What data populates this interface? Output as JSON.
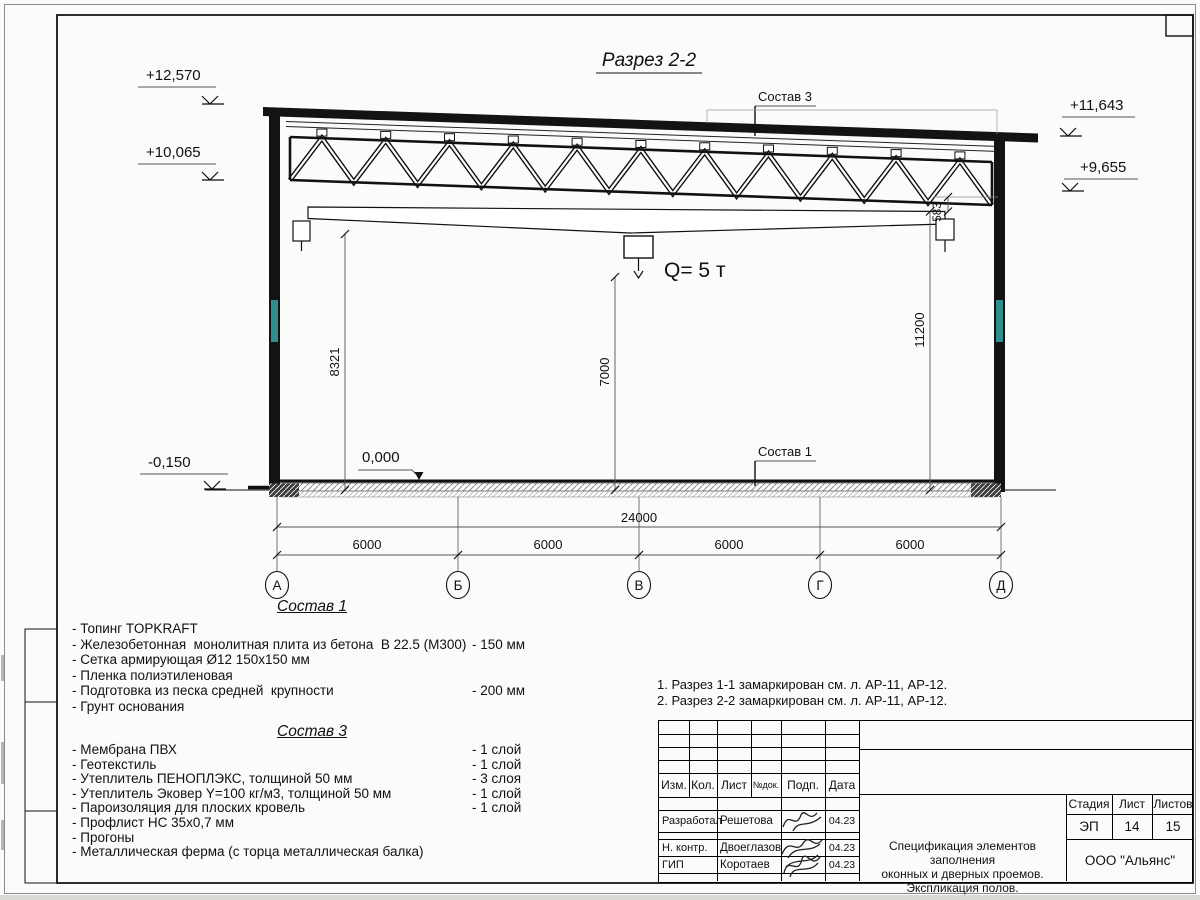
{
  "drawing": {
    "section_title": "Разрез 2-2",
    "crane_load": "Q= 5 т",
    "sostav3_label": "Состав 3",
    "sostav1_label": "Состав 1",
    "zero_mark": "0,000",
    "elev": {
      "l1": "+12,570",
      "l2": "+10,065",
      "l3": "-0,150",
      "r1": "+11,643",
      "r2": "+9,655"
    },
    "dims": {
      "h_left": "8321",
      "h_mid": "7000",
      "h_right": "11200",
      "truss_gap": "583",
      "total": "24000",
      "spans": [
        "6000",
        "6000",
        "6000",
        "6000"
      ]
    },
    "axes": [
      "А",
      "Б",
      "В",
      "Г",
      "Д"
    ],
    "colors": {
      "accent_teal": "#2f8f8f",
      "line": "#111111"
    }
  },
  "sostav1": {
    "heading": "Состав 1",
    "items": [
      {
        "text": "- Топинг TOPKRAFT",
        "value": ""
      },
      {
        "text": "- Железобетонная  монолитная плита из бетона  В 22.5 (М300)",
        "value": "- 150 мм"
      },
      {
        "text": "- Сетка армирующая Ø12 150x150 мм",
        "value": ""
      },
      {
        "text": "- Пленка полиэтиленовая",
        "value": ""
      },
      {
        "text": "- Подготовка из песка средней  крупности",
        "value": "- 200 мм"
      },
      {
        "text": "- Грунт основания",
        "value": ""
      }
    ]
  },
  "sostav3": {
    "heading": "Состав 3",
    "items": [
      {
        "text": "- Мембрана ПВХ",
        "value": "- 1 слой"
      },
      {
        "text": "- Геотекстиль",
        "value": "- 1 слой"
      },
      {
        "text": "- Утеплитель ПЕНОПЛЭКС, толщиной 50 мм",
        "value": "- 3 слоя"
      },
      {
        "text": "- Утеплитель Эковер Y=100 кг/м3, толщиной 50 мм",
        "value": "- 1 слой"
      },
      {
        "text": "- Пароизоляция для плоских кровель",
        "value": "- 1 слой"
      },
      {
        "text": "- Профлист НС 35х0,7 мм",
        "value": ""
      },
      {
        "text": "- Прогоны",
        "value": ""
      },
      {
        "text": "- Металлическая ферма (с торца металлическая балка)",
        "value": ""
      }
    ]
  },
  "notes": [
    "1. Разрез 1-1 замаркирован см. л. АР-11, АР-12.",
    "2. Разрез 2-2 замаркирован см. л. АР-11, АР-12."
  ],
  "stamp": {
    "header": {
      "izm": "Изм.",
      "kol": "Кол.",
      "list": "Лист",
      "ndok": "№док.",
      "podp": "Подп.",
      "data": "Дата"
    },
    "rows": [
      {
        "role": "Разработал",
        "name": "Решетова",
        "date": "04.23"
      },
      {
        "role": "Н. контр.",
        "name": "Двоеглазов",
        "date": "04.23"
      },
      {
        "role": "ГИП",
        "name": "Коротаев",
        "date": "04.23"
      }
    ],
    "title_lines": [
      "Спецификация элементов заполнения",
      "оконных и дверных проемов.",
      "Экспликация полов."
    ],
    "stage": {
      "h1": "Стадия",
      "h2": "Лист",
      "h3": "Листов",
      "v1": "ЭП",
      "v2": "14",
      "v3": "15"
    },
    "org": "ООО \"Альянс\""
  }
}
